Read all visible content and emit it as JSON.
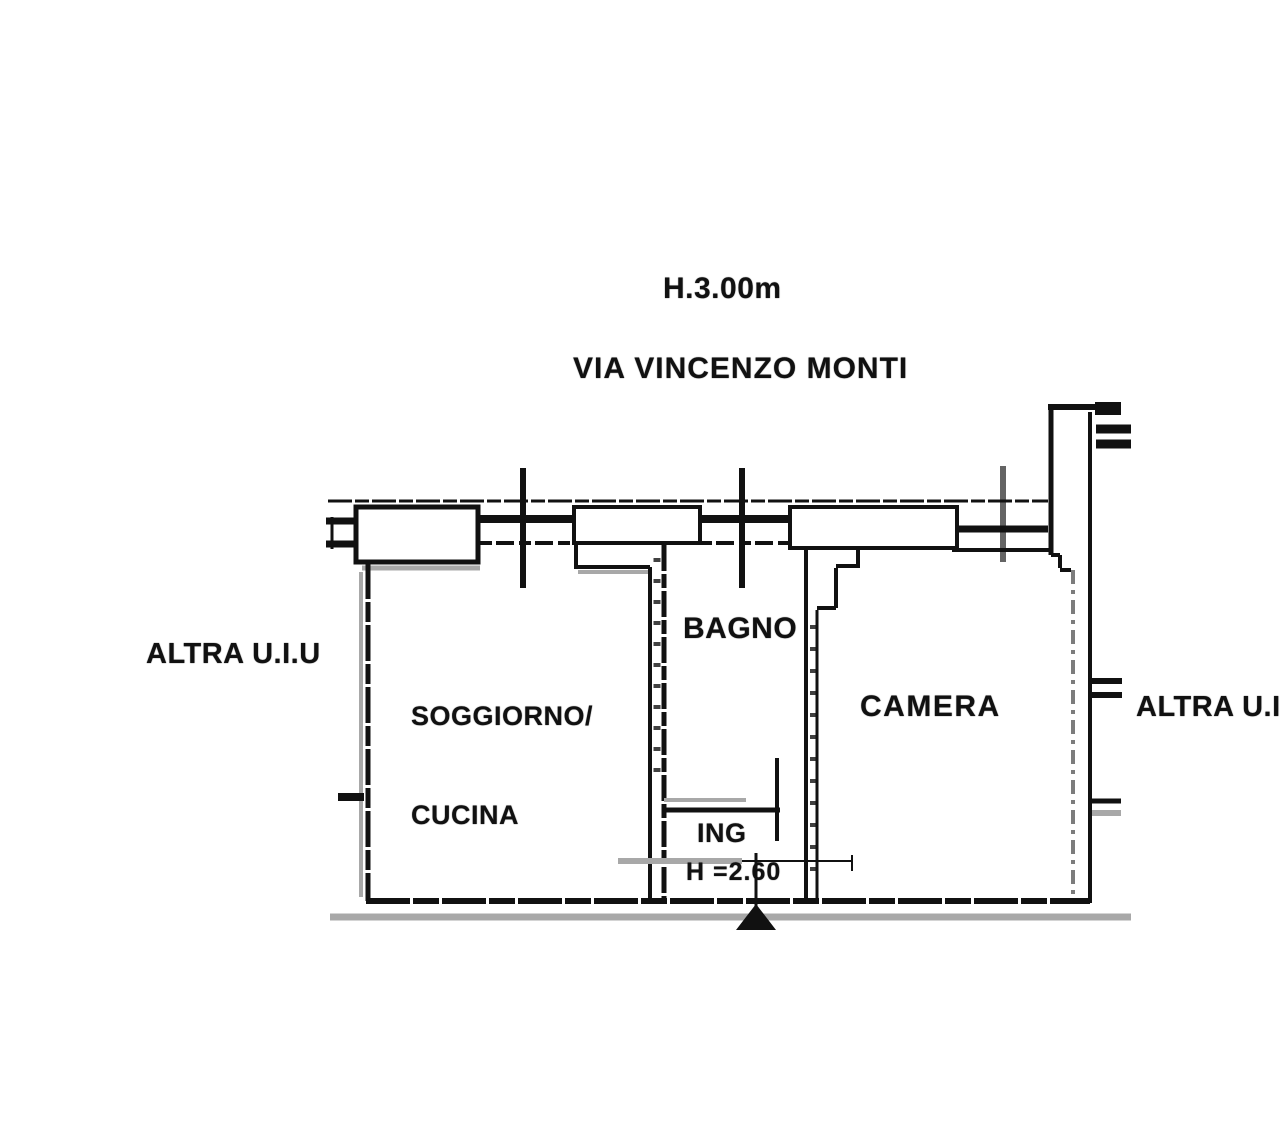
{
  "document": {
    "kind": "scanned apartment floor plan",
    "orientation_street_side": "top"
  },
  "annotations": {
    "ceiling_height": "H.3.00m",
    "street": "VIA VINCENZO MONTI",
    "adjacent_unit_left": "ALTRA U.I.U",
    "adjacent_unit_right": "ALTRA U.I."
  },
  "rooms": [
    {
      "name": "soggiorno-cucina",
      "label_line1": "SOGGIORNO/",
      "label_line2": "CUCINA"
    },
    {
      "name": "bagno",
      "label": "BAGNO"
    },
    {
      "name": "camera",
      "label": "CAMERA"
    },
    {
      "name": "ingresso",
      "label": "ING",
      "ceiling_height": "H =2.60"
    }
  ],
  "colors": {
    "wall": "#111111",
    "shadow": "#a8a8a8",
    "background": "#ffffff",
    "text": "#111111"
  }
}
